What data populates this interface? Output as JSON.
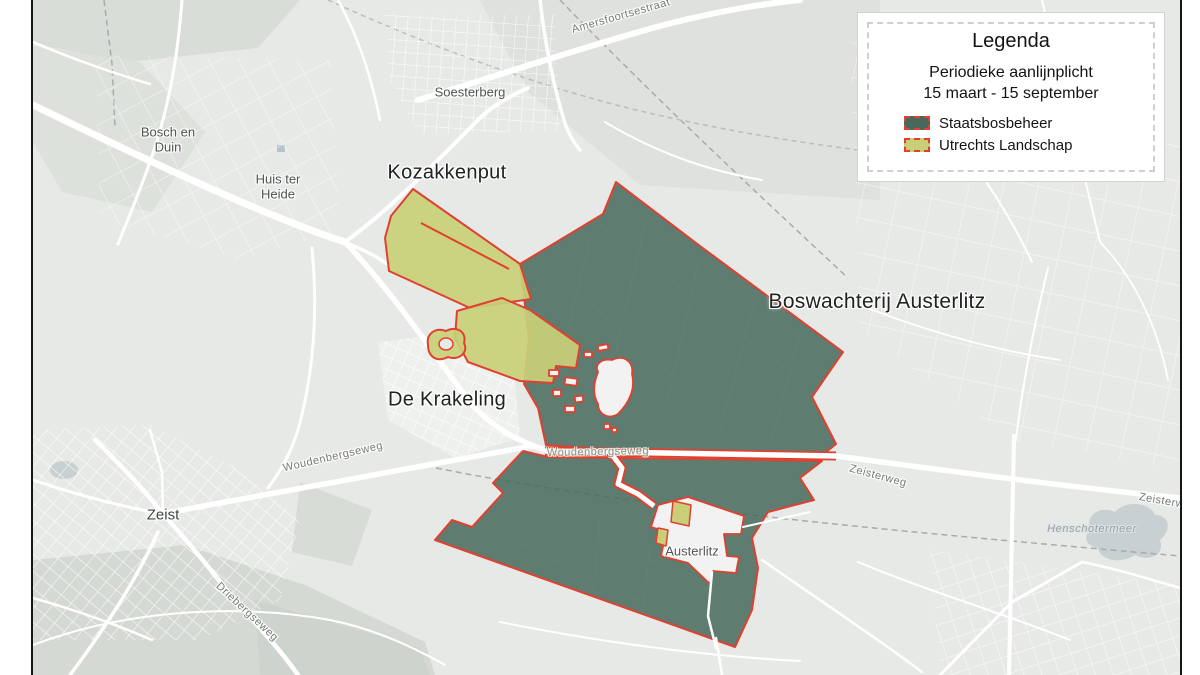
{
  "colors": {
    "staatsbosbeheer": "#47685a",
    "utrechts_landschap": "#c9cf77",
    "boundary_red": "#e0402f",
    "map_background": "#e7e9e7",
    "water": "#c8d0d2"
  },
  "legend": {
    "title": "Legenda",
    "subtitle_line1": "Periodieke aanlijnplicht",
    "subtitle_line2": "15 maart - 15 september",
    "items": [
      {
        "label": "Staatsbosbeheer"
      },
      {
        "label": "Utrechts Landschap"
      }
    ]
  },
  "map_labels": {
    "areas": {
      "kozakkenput": "Kozakkenput",
      "de_krakeling": "De Krakeling",
      "boswachterij_austerlitz": "Boswachterij Austerlitz"
    },
    "places": {
      "bosch_en_duin": "Bosch en Duin",
      "huis_ter_heide": "Huis ter Heide",
      "soesterberg": "Soesterberg",
      "zeist": "Zeist",
      "austerlitz": "Austerlitz"
    },
    "roads": {
      "amersfoortsestraat": "Amersfoortsestraat",
      "woudenbergseweg_west": "Woudenbergseweg",
      "woudenbergseweg_east": "Woudenbergseweg",
      "driebergseweg": "Driebergseweg",
      "zeisterweg": "Zeisterweg",
      "zeisterweg_edge": "Zeisterweg"
    },
    "water": {
      "henschotermeer": "Henschotermeer"
    }
  }
}
